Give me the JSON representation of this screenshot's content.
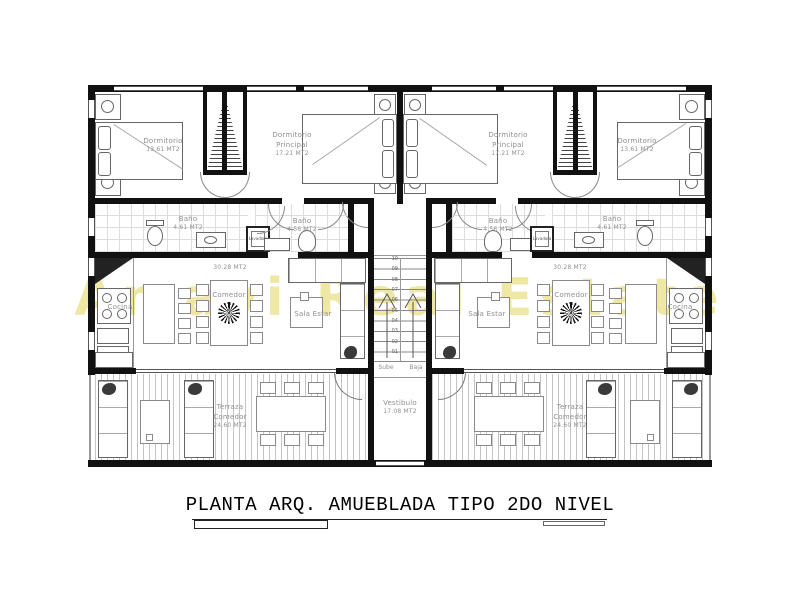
{
  "title": "PLANTA ARQ. AMUEBLADA TIPO 2DO NIVEL",
  "watermark": "Amavi Real Estate",
  "rooms": {
    "dormitorio": {
      "name": "Dormitorio",
      "area": "13.61 MT2"
    },
    "dormitorio_principal": {
      "line1": "Dormitorio",
      "line2": "Principal",
      "area": "17.21 MT2"
    },
    "bano_a": {
      "name": "Baño",
      "area": "4.61 MT2"
    },
    "bano_b": {
      "name": "Baño",
      "area": "4.56 MT2"
    },
    "cocina": {
      "name": "Cocina"
    },
    "comedor": {
      "name": "Comedor",
      "area": "30.28 MT2"
    },
    "sala_estar": {
      "name": "Sala Estar"
    },
    "terraza": {
      "line1": "Terraza",
      "line2": "Comedor",
      "area": "24.60 MT2"
    },
    "vestibulo": {
      "name": "Vestibulo",
      "area": "17.08 MT2"
    },
    "lavadora": {
      "name": "Lavadora"
    }
  },
  "stairs": {
    "sube": "Sube",
    "baja": "Baja",
    "steps": [
      "01",
      "02",
      "03",
      "04",
      "05",
      "06",
      "07",
      "08",
      "09",
      "10"
    ]
  }
}
